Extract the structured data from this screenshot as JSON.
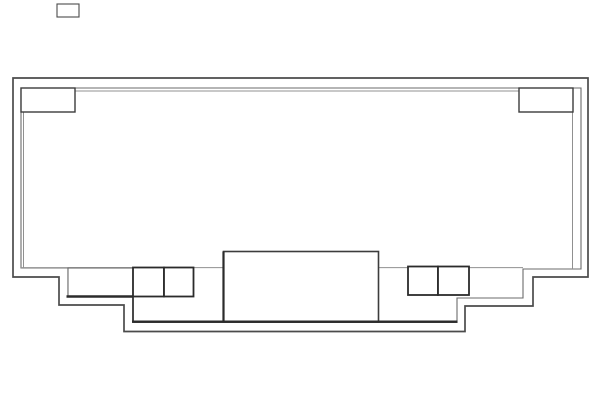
{
  "canvas": {
    "width": 602,
    "height": 418,
    "background": "#ffffff"
  },
  "palette": {
    "outer_wall": "#4b4b4b",
    "inner_wall": "#6b6b6b",
    "thin_line": "#909090",
    "bold_line": "#2b2b2b",
    "box_stroke": "#3c3c3c",
    "white": "#ffffff"
  },
  "drawing": {
    "shapes": [
      {
        "name": "outer-wall-outline",
        "type": "polygon",
        "stroke": "outer_wall",
        "strokeWidth": 1.7,
        "fill": "none",
        "points": "13,78 588,78 588,277 533,277 533,306 465,306 465,331.5 124,331.5 124,305 59,305 59,277 13,277"
      },
      {
        "name": "inner-wall-outline",
        "type": "polygon",
        "stroke": "inner_wall",
        "strokeWidth": 1.1,
        "fill": "none",
        "points": "21,88 581,88 581,269 523,269 523,298 457,298 457,322.5 133,322.5 133,296.5 68,296.5 68,268 21,268"
      },
      {
        "name": "top-trim-line",
        "type": "line",
        "x1": 75,
        "y1": 91,
        "x2": 519,
        "y2": 91,
        "stroke": "thin_line",
        "strokeWidth": 1
      },
      {
        "name": "left-trim-line",
        "type": "line",
        "x1": 23.5,
        "y1": 112,
        "x2": 23.5,
        "y2": 268,
        "stroke": "thin_line",
        "strokeWidth": 1
      },
      {
        "name": "right-trim-line",
        "type": "line",
        "x1": 572.5,
        "y1": 112,
        "x2": 572.5,
        "y2": 269,
        "stroke": "thin_line",
        "strokeWidth": 1
      },
      {
        "name": "ledge-line-left",
        "type": "line",
        "x1": 21,
        "y1": 267.6,
        "x2": 223.5,
        "y2": 267.6,
        "stroke": "thin_line",
        "strokeWidth": 1
      },
      {
        "name": "ledge-line-right",
        "type": "line",
        "x1": 378.5,
        "y1": 267.6,
        "x2": 523,
        "y2": 267.6,
        "stroke": "thin_line",
        "strokeWidth": 1
      },
      {
        "name": "detached-top-box",
        "type": "rect",
        "x": 57,
        "y": 4,
        "w": 22,
        "h": 13,
        "stroke": "outer_wall",
        "strokeWidth": 1.1,
        "fill": "white"
      },
      {
        "name": "top-left-corner-box",
        "type": "rect",
        "x": 21,
        "y": 88,
        "w": 54,
        "h": 24,
        "stroke": "box_stroke",
        "strokeWidth": 1.4,
        "fill": "white"
      },
      {
        "name": "top-right-corner-box",
        "type": "rect",
        "x": 519,
        "y": 88,
        "w": 54,
        "h": 24,
        "stroke": "box_stroke",
        "strokeWidth": 1.4,
        "fill": "white"
      },
      {
        "name": "left-step-cell",
        "type": "rect",
        "x": 68,
        "y": 268,
        "w": 65,
        "h": 28.5,
        "stroke": "inner_wall",
        "strokeWidth": 1.1,
        "fill": "white"
      },
      {
        "name": "center-console-box",
        "type": "rect",
        "x": 223.5,
        "y": 251.5,
        "w": 155,
        "h": 70.5,
        "stroke": "box_stroke",
        "strokeWidth": 1.6,
        "fill": "white"
      },
      {
        "name": "left-box-pair-cell-a",
        "type": "rect",
        "x": 133,
        "y": 267.5,
        "w": 31,
        "h": 29,
        "stroke": "bold_line",
        "strokeWidth": 1.8,
        "fill": "white"
      },
      {
        "name": "left-box-pair-cell-b",
        "type": "rect",
        "x": 164,
        "y": 267.5,
        "w": 29.5,
        "h": 29,
        "stroke": "bold_line",
        "strokeWidth": 1.8,
        "fill": "white"
      },
      {
        "name": "right-box-pair-cell-a",
        "type": "rect",
        "x": 408,
        "y": 266.5,
        "w": 30,
        "h": 28.5,
        "stroke": "bold_line",
        "strokeWidth": 1.8,
        "fill": "white"
      },
      {
        "name": "right-box-pair-cell-b",
        "type": "rect",
        "x": 438,
        "y": 266.5,
        "w": 31,
        "h": 28.5,
        "stroke": "bold_line",
        "strokeWidth": 1.8,
        "fill": "white"
      },
      {
        "name": "left-cell-bold-bottom-line",
        "type": "line",
        "x1": 66.5,
        "y1": 296.5,
        "x2": 133.5,
        "y2": 296.5,
        "stroke": "bold_line",
        "strokeWidth": 2.6
      },
      {
        "name": "left-step-bold-vertical",
        "type": "line",
        "x1": 133,
        "y1": 296.5,
        "x2": 133,
        "y2": 322.5,
        "stroke": "bold_line",
        "strokeWidth": 1.7
      },
      {
        "name": "inner-bottom-bold-line",
        "type": "line",
        "x1": 132,
        "y1": 321.7,
        "x2": 457.5,
        "y2": 321.7,
        "stroke": "bold_line",
        "strokeWidth": 2.4
      },
      {
        "name": "center-box-left-bold-edge",
        "type": "line",
        "x1": 223.5,
        "y1": 251.5,
        "x2": 223.5,
        "y2": 322,
        "stroke": "bold_line",
        "strokeWidth": 2.2
      }
    ]
  }
}
